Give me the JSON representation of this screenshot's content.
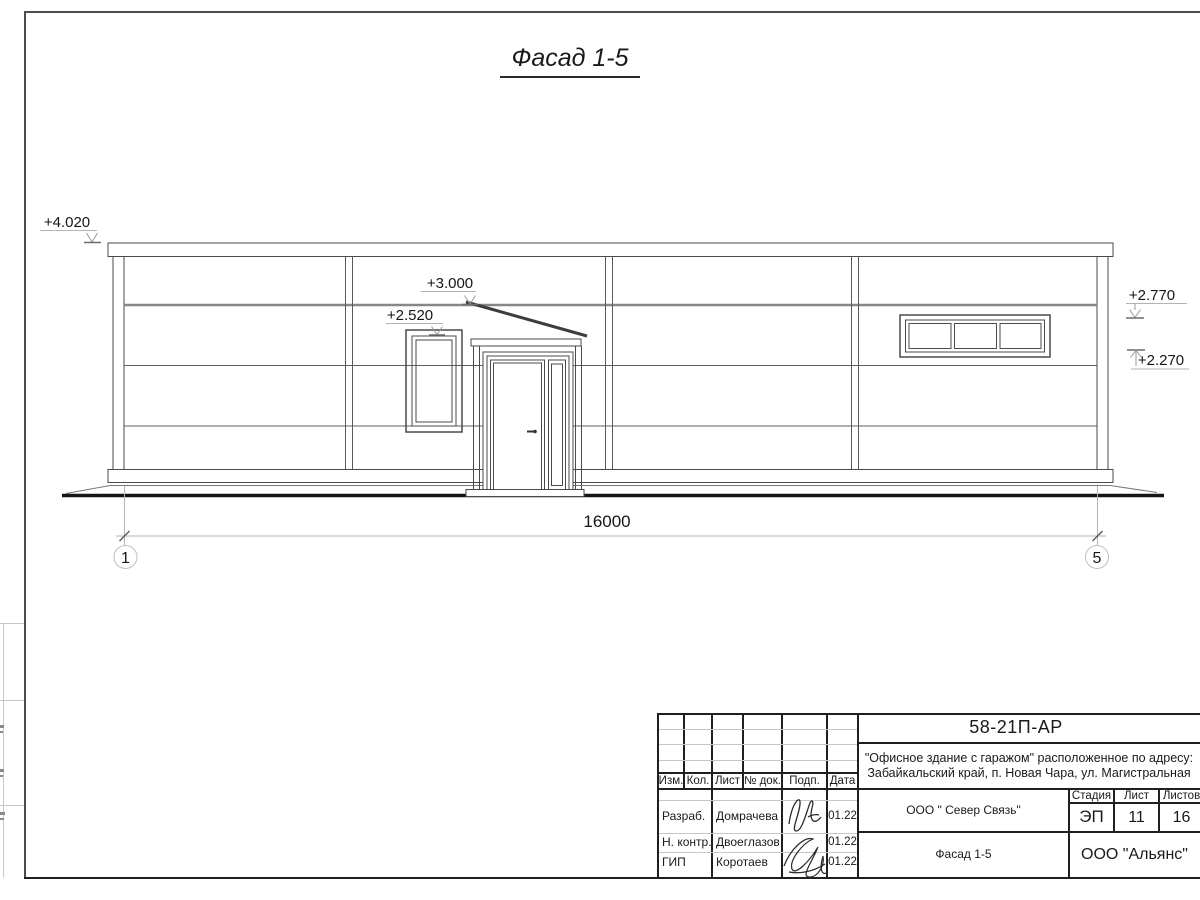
{
  "drawing_title": "Фасад 1-5",
  "elevation_marks": {
    "parapet": "+4.020",
    "canopy": "+3.000",
    "entrance_window": "+2.520",
    "ribbon_window_top": "+2.770",
    "ribbon_window_bottom": "+2.270"
  },
  "dimension": {
    "length": "16000",
    "axis_start": "1",
    "axis_end": "5"
  },
  "title_block": {
    "doc_number": "58-21П-АР",
    "project_line1": "\"Офисное здание с гаражом\" расположенное по адресу:",
    "project_line2": "Забайкальский край, п. Новая Чара, ул. Магистральная",
    "columns": [
      "Изм.",
      "Кол.",
      "Лист",
      "№ док.",
      "Подп.",
      "Дата"
    ],
    "rows": [
      {
        "role": "Разраб.",
        "name": "Домрачева",
        "date": "01.22"
      },
      {
        "role": "Н. контр.",
        "name": "Двоеглазов",
        "date": "01.22"
      },
      {
        "role": "ГИП",
        "name": "Коротаев",
        "date": "01.22"
      }
    ],
    "contractor": "ООО \" Север Связь\"",
    "stage_label": "Стадия",
    "stage": "ЭП",
    "sheet_label": "Лист",
    "sheet": "11",
    "sheets_label": "Листов",
    "sheets": "16",
    "view_name": "Фасад 1-5",
    "organization": "ООО \"Альянс\""
  },
  "colors": {
    "line_dark": "#1f1f1f",
    "line_medium": "#4a4a4a",
    "line_light": "#b3b3b3",
    "siding_accent": "#878787"
  }
}
